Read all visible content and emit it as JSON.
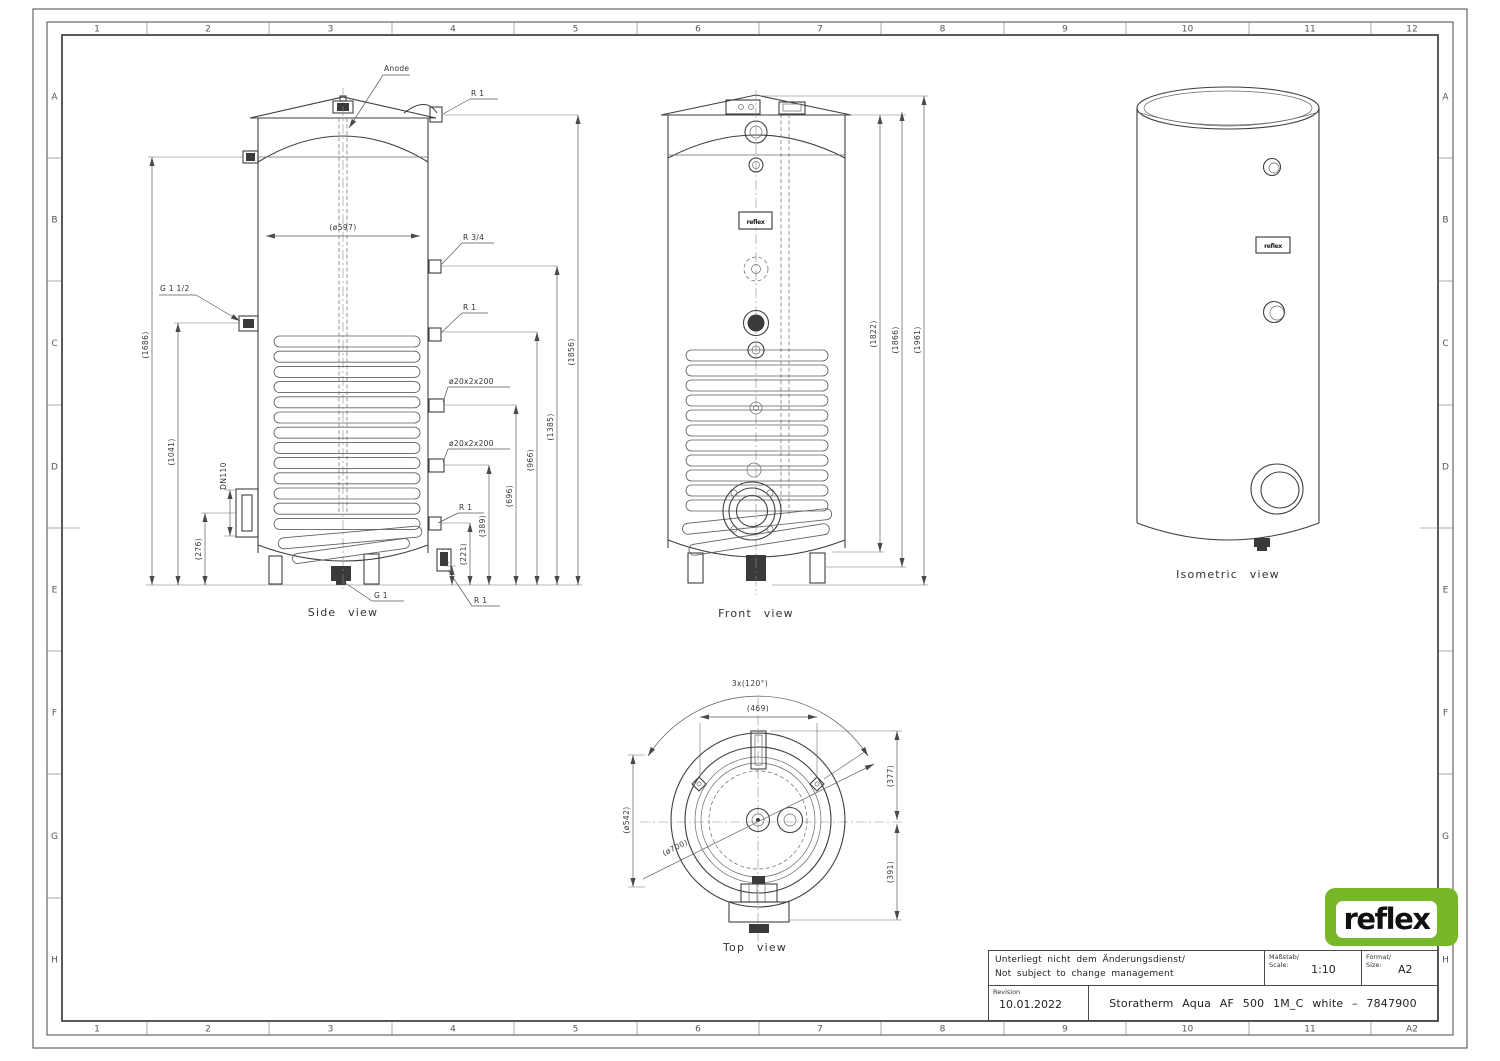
{
  "frame": {
    "top_labels": [
      "1",
      "2",
      "3",
      "4",
      "5",
      "6",
      "7",
      "8",
      "9",
      "10",
      "11",
      "12"
    ],
    "bottom_labels": [
      "1",
      "2",
      "3",
      "4",
      "5",
      "6",
      "7",
      "8",
      "9",
      "10",
      "11",
      "A2"
    ],
    "side_labels": [
      "A",
      "B",
      "C",
      "D",
      "E",
      "F",
      "G",
      "H"
    ]
  },
  "side_view": {
    "caption": "Side view",
    "anode_label": "Anode",
    "fitting_labels": {
      "r1_top": "R 1",
      "r34": "R 3/4",
      "r1_mid": "R 1",
      "pipe_upper": "ø20x2x200",
      "pipe_lower": "ø20x2x200",
      "r1_low": "R 1",
      "g1_half": "G 1 1/2",
      "g1": "G 1",
      "r1_bottom": "R 1",
      "dn110": "DN110"
    },
    "dimensions": {
      "d597": "(ø597)",
      "h1686": "(1686)",
      "h1041": "(1041)",
      "h276": "(276)",
      "h55": "(55)",
      "h221": "(221)",
      "h389": "(389)",
      "h696": "(696)",
      "h966": "(966)",
      "h1385": "(1385)",
      "h1856": "(1856)"
    }
  },
  "front_view": {
    "caption": "Front view",
    "dimensions": {
      "h1822": "(1822)",
      "h1866": "(1866)",
      "h1961": "(1961)"
    }
  },
  "isometric_view": {
    "caption": "Isometric view"
  },
  "top_view": {
    "caption": "Top view",
    "dimensions": {
      "arc": "3x(120°)",
      "w469": "(469)",
      "h377": "(377)",
      "h391": "(391)",
      "d542": "(ø542)",
      "d700": "(ø700)"
    }
  },
  "title_block": {
    "note_line1": "Unterliegt nicht dem Änderungsdienst/",
    "note_line2": "Not subject to change management",
    "scale_label_de": "Maßstab/",
    "scale_label_en": "Scale:",
    "scale_value": "1:10",
    "format_label_de": "Format/",
    "format_label_en": "Size:",
    "format_value": "A2",
    "revision_label": "Revision",
    "revision_date": "10.01.2022",
    "drawing_title": "Storatherm Aqua AF 500 1M_C white – 7847900"
  },
  "logo": {
    "text": "reflex",
    "color": "#76b82a"
  },
  "nameplate_text": "reflex"
}
